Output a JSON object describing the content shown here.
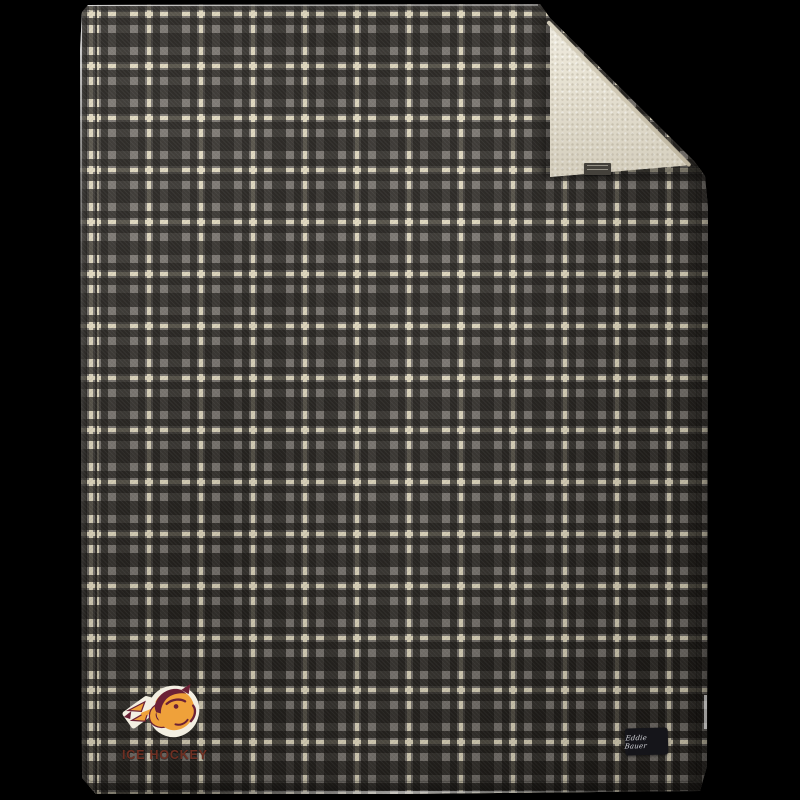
{
  "scene": {
    "width": 800,
    "height": 800,
    "background_color": "#000000"
  },
  "blanket": {
    "plaid": {
      "base_color": "#7b7670",
      "dark_stripe_color": "#23201c",
      "cream_stripe_color": "#ece3c6",
      "repeat_px": 52
    },
    "sherpa_corner": {
      "color": "#e9e4d5",
      "edge_trim_color": "#cdc5b0"
    },
    "care_tag": {
      "background_color": "#44413b"
    },
    "brand_label": {
      "text": "Eddie Bauer",
      "background_color": "#15151a",
      "text_color": "#d4d5da"
    },
    "logo": {
      "text": "ICE HOCKEY",
      "text_color": "#6f2f22",
      "gold_color": "#efa13a",
      "maroon_color": "#6b2136",
      "outline_color": "#f3efe2"
    }
  }
}
